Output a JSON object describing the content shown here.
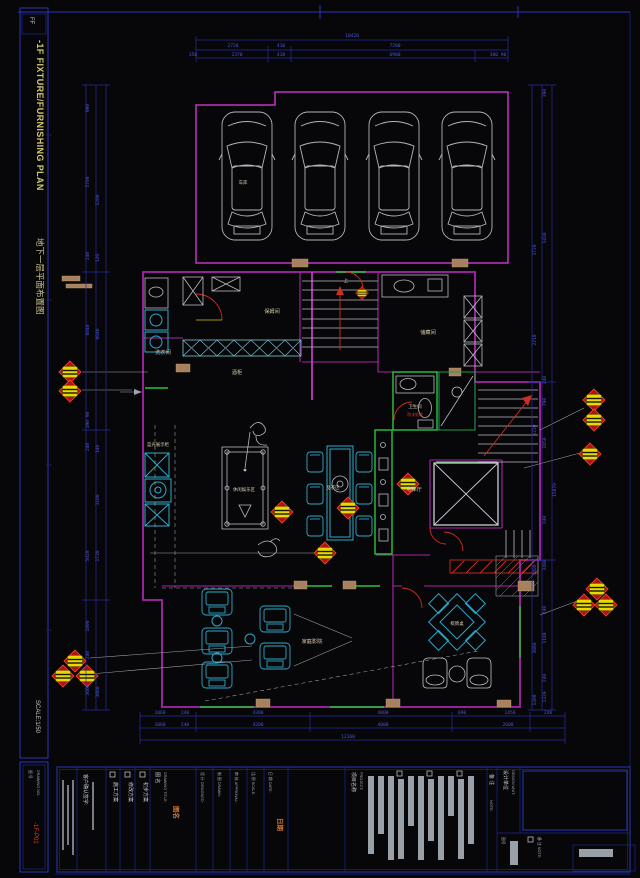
{
  "frame": {
    "code": "FF",
    "plan_title_en": "-1F FIXTURE/FURNISHING PLAN",
    "plan_title_cn": "地下一层平面布置图",
    "scale": "SCALE:1/50",
    "dno_label": "图 号",
    "dno_en": "DRAWING NO.",
    "dno_value": "-1F-P01"
  },
  "dims": {
    "top": [
      "10420",
      "2720",
      "410",
      "7290",
      "350",
      "2370",
      "410",
      "6900",
      "300 90"
    ],
    "left": [
      "990",
      "5700",
      "1200",
      "240",
      "120",
      "6040",
      "6040",
      "190 90",
      "240",
      "140",
      "3100",
      "5020",
      "1730",
      "1890",
      "240",
      "3660",
      "3660"
    ],
    "right": [
      "390",
      "1430",
      "3720",
      "240",
      "790",
      "2210",
      "5230",
      "1650",
      "15870",
      "240",
      "3400",
      "3400",
      "240",
      "1180",
      "3680",
      "240",
      "1320",
      "1300"
    ],
    "bottom": [
      "1060",
      "240",
      "4300",
      "4000",
      "690",
      "1450",
      "240",
      "1060",
      "240",
      "4200",
      "4000",
      "2600",
      "12160"
    ]
  },
  "rooms": {
    "garage": "车库",
    "nanny": "保姆间",
    "laundry": "洗衣间",
    "wine": "酒柜",
    "storage": "储藏间",
    "bath": "卫生间",
    "bath_note": "防水处理",
    "hall": "电梯厅",
    "tea": "品茶区",
    "leisure": "休闲娱乐区",
    "display": "蓝光展示柜",
    "cinema": "家庭影院",
    "mahjong": "棋牌桌",
    "up": "上"
  },
  "title": {
    "confirm": "客户确认签字:",
    "scheme1": "施工方案",
    "scheme2": "修改方案",
    "scheme3": "初步方案",
    "drawing_title": "图 名",
    "drawing_title_en": "DRAWING TITLE:",
    "drawing_title_stamp": "图名",
    "f1": "设 计 DESIGNED:",
    "f2": "制 图 DRAWN:",
    "f3": "审 核 APPROVAL:",
    "f4": "比 例 SCALE:",
    "f5": "日 期 DATE:",
    "date_stamp": "日期",
    "project": "项目名称",
    "project_en": "PROJECT:",
    "note": "备 注",
    "note_en": "NOTE:",
    "unit": "设计单位",
    "unit_en": "DESIGN UNIT:",
    "dno": "图号",
    "note2": "备 注 NOTE:"
  }
}
